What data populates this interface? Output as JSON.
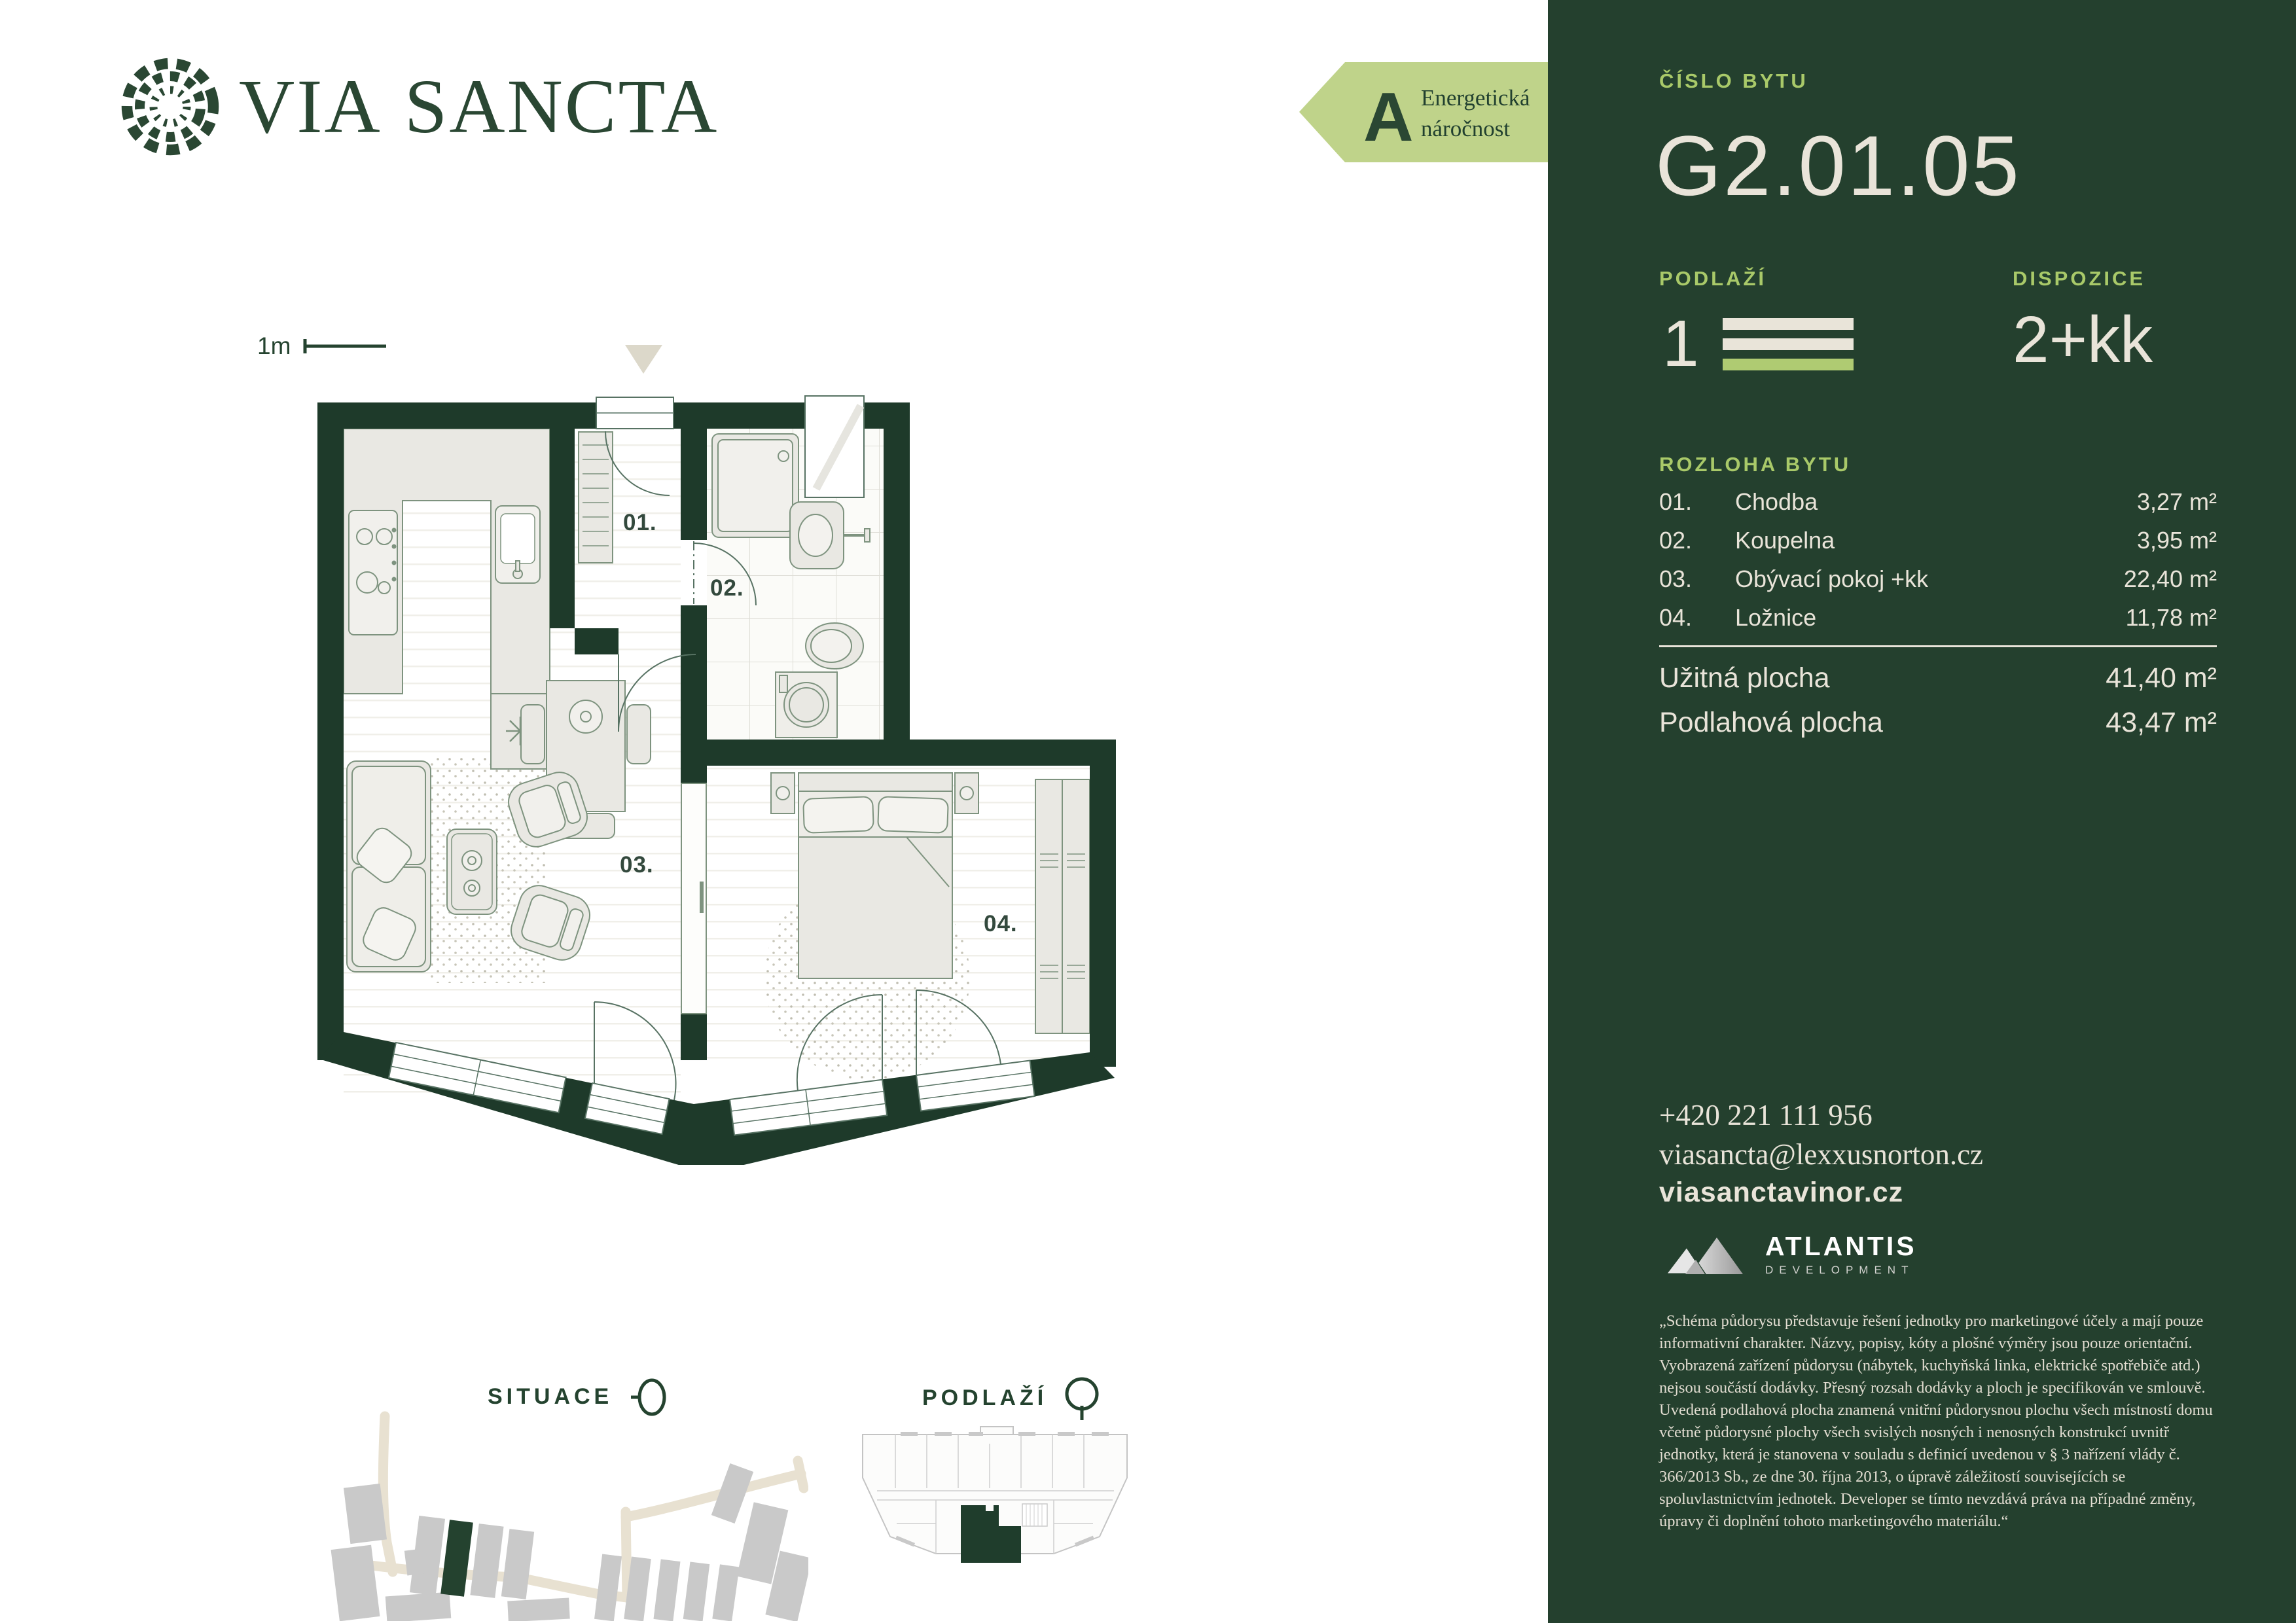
{
  "brand": {
    "via": "VIA",
    "sancta": "SANCTA"
  },
  "energy": {
    "grade": "A",
    "line1": "Energetická",
    "line2": "náročnost"
  },
  "plan": {
    "scale_label": "1m",
    "rooms": {
      "r01": "01.",
      "r02": "02.",
      "r03": "03.",
      "r04": "04."
    }
  },
  "maps": {
    "situace_title": "SITUACE",
    "podlazi_title": "PODLAŽÍ"
  },
  "panel": {
    "unit_label": "ČÍSLO BYTU",
    "unit_number": "G2.01.05",
    "floor_label": "PODLAŽÍ",
    "floor_value": "1",
    "layout_label": "DISPOZICE",
    "layout_value": "2+kk",
    "area_label": "ROZLOHA BYTU",
    "rooms": [
      {
        "index": "01.",
        "name": "Chodba",
        "area": "3,27 m²"
      },
      {
        "index": "02.",
        "name": "Koupelna",
        "area": "3,95 m²"
      },
      {
        "index": "03.",
        "name": "Obývací pokoj +kk",
        "area": "22,40 m²"
      },
      {
        "index": "04.",
        "name": "Ložnice",
        "area": "11,78 m²"
      }
    ],
    "usable_label": "Užitná plocha",
    "usable_value": "41,40 m²",
    "floor_area_label": "Podlahová plocha",
    "floor_area_value": "43,47 m²",
    "phone": "+420 221 111 956",
    "email": "viasancta@lexxusnorton.cz",
    "website": "viasanctavinor.cz",
    "developer_name": "ATLANTIS",
    "developer_subtitle": "DEVELOPMENT",
    "disclaimer": "„Schéma půdorysu představuje řešení jednotky pro marketingové účely a mají pouze informativní charakter. Názvy, popisy, kóty a plošné výměry jsou pouze orientační. Vyobrazená zařízení půdorysu (nábytek, kuchyňská linka, elektrické spotřebiče atd.) nejsou součástí dodávky. Přesný rozsah dodávky a ploch je specifikován ve smlouvě. Uvedená podlahová plocha znamená vnitřní půdorysnou plochu všech místností domu včetně půdorysné plochy všech svislých nosných i nenosných konstrukcí uvnitř jednotky, která je stanovena v souladu s definicí uvedenou v § 3 nařízení vlády č. 366/2013 Sb., ze dne 30. října 2013, o úpravě záležitostí souvisejících se spoluvlastnictvím jednotek. Developer se tímto nevzdává práva na případné změny, úpravy či doplnění tohoto marketingového materiálu.“"
  },
  "colors": {
    "panel_green": "#24402E",
    "wall_green": "#1E3A2A",
    "accent_green": "#A9C969",
    "cream": "#E9E4D9",
    "energy_arrow": "#BFD38A"
  }
}
